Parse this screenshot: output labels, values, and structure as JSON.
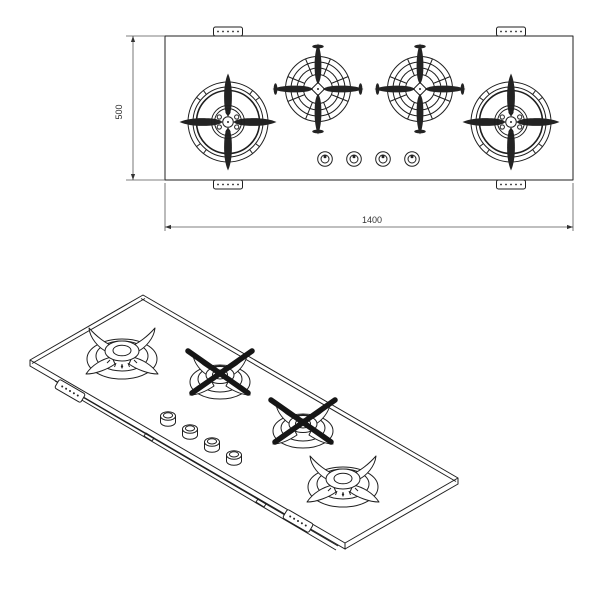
{
  "colors": {
    "background": "#ffffff",
    "line": "#1f1f1f",
    "dimension_line": "#555555",
    "dimension_text": "#333333"
  },
  "plan_view": {
    "width_dim": "1400",
    "depth_dim": "500",
    "burner_count": 4,
    "knob_count": 4,
    "bracket_count": 4
  },
  "iso_view": {
    "burner_count": 4,
    "knob_count": 4,
    "bracket_count": 2
  }
}
